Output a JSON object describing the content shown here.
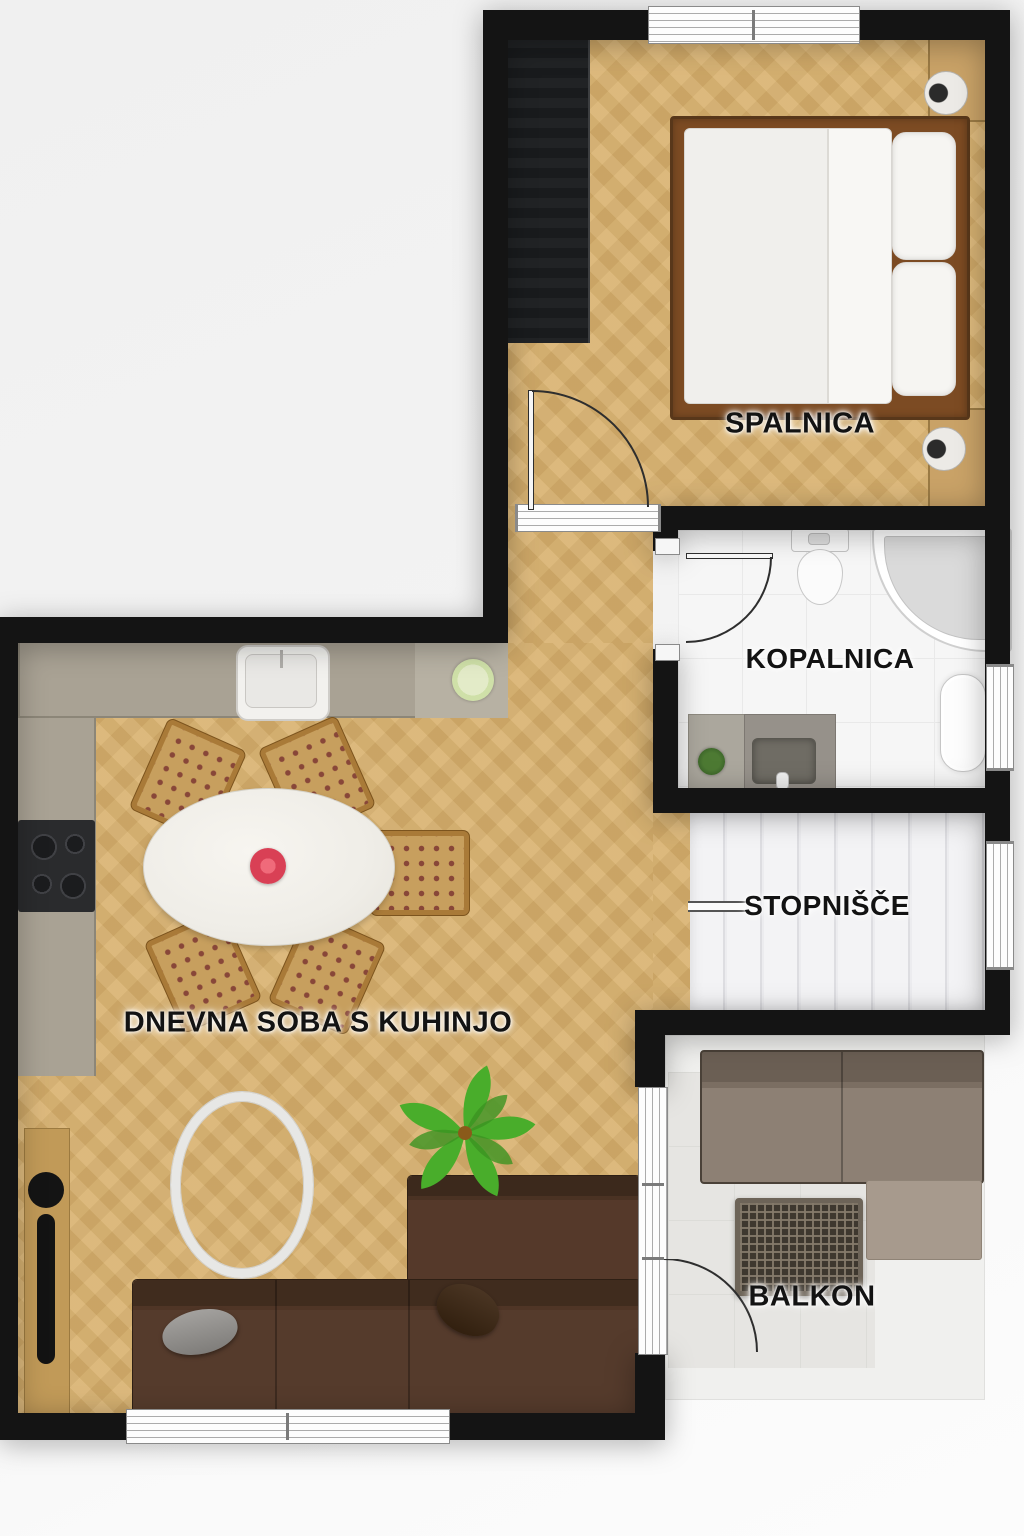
{
  "plan": {
    "kind": "apartment-floor-plan-top-view",
    "language": "Slovenian",
    "rooms": {
      "bedroom": {
        "label": "SPALNICA"
      },
      "bathroom": {
        "label": "KOPALNICA"
      },
      "staircase": {
        "label": "STOPNIŠČE"
      },
      "balcony": {
        "label": "BALKON"
      },
      "living_kitchen": {
        "label": "DNEVNA SOBA S KUHINJO"
      }
    },
    "inventory": {
      "bedroom": [
        "wardrobe",
        "double-bed",
        "duvet",
        "pillows",
        "nightstand-top",
        "nightstand-bottom",
        "bedside-lamps",
        "door",
        "window"
      ],
      "bathroom": [
        "toilet",
        "corner-shower",
        "vanity-counter",
        "sink-basin",
        "faucet",
        "small-plant",
        "radiator",
        "door",
        "window"
      ],
      "staircase": [
        "eight-treads",
        "handrail",
        "window"
      ],
      "balcony": [
        "outdoor-sofa",
        "ottoman",
        "rattan-coffee-table",
        "balcony-door"
      ],
      "living_kitchen": [
        "l-shaped-counter",
        "kitchen-sink",
        "cooktop",
        "small-plant",
        "oval-dining-table",
        "flower-centerpiece",
        "five-chairs",
        "round-ring-rug",
        "large-plant",
        "corner-sofa",
        "gray-pillow",
        "brown-pillow",
        "sideboard",
        "tv-unit",
        "windows"
      ]
    },
    "colors": {
      "wall": "#141414",
      "background": "#f2f2f2",
      "wood_floor": "#d8b06c",
      "kitchen_counter": "#a9a294",
      "sofa_brown": "#4c3425",
      "balcony_sofa_taupe": "#8a7d71",
      "plant_green": "#49ad2b",
      "flower_red": "#d94055",
      "bathroom_floor": "#f6f6f6",
      "stairs_floor": "#f0f0f2",
      "bed_frame_brown": "#7c4b23",
      "linen_white": "#f3f2ef"
    }
  }
}
